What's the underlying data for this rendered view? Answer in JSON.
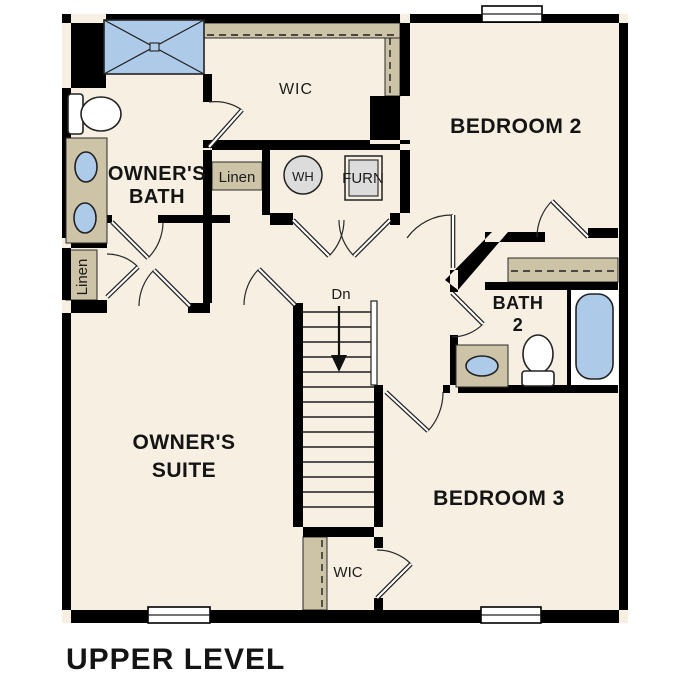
{
  "title": "UPPER LEVEL",
  "colors": {
    "wall": "#000000",
    "floor": "#f6efe2",
    "shelf": "#cdc3a6",
    "fixture": "#aecae9",
    "equipment": "#dcdcdc"
  },
  "rooms": {
    "owners_bath": {
      "line1": "OWNER'S",
      "line2": "BATH"
    },
    "owners_suite": {
      "line1": "OWNER'S",
      "line2": "SUITE"
    },
    "bedroom2": {
      "label": "BEDROOM 2"
    },
    "bedroom3": {
      "label": "BEDROOM 3"
    },
    "bath2": {
      "line1": "BATH",
      "line2": "2"
    },
    "wic_top": {
      "label": "WIC"
    },
    "wic_bottom": {
      "label": "WIC"
    },
    "linen_mid": {
      "label": "Linen"
    },
    "linen_left": {
      "label": "Linen"
    }
  },
  "equipment": {
    "water_heater": "WH",
    "furnace": "FURN"
  },
  "stairs": {
    "direction_label": "Dn"
  }
}
